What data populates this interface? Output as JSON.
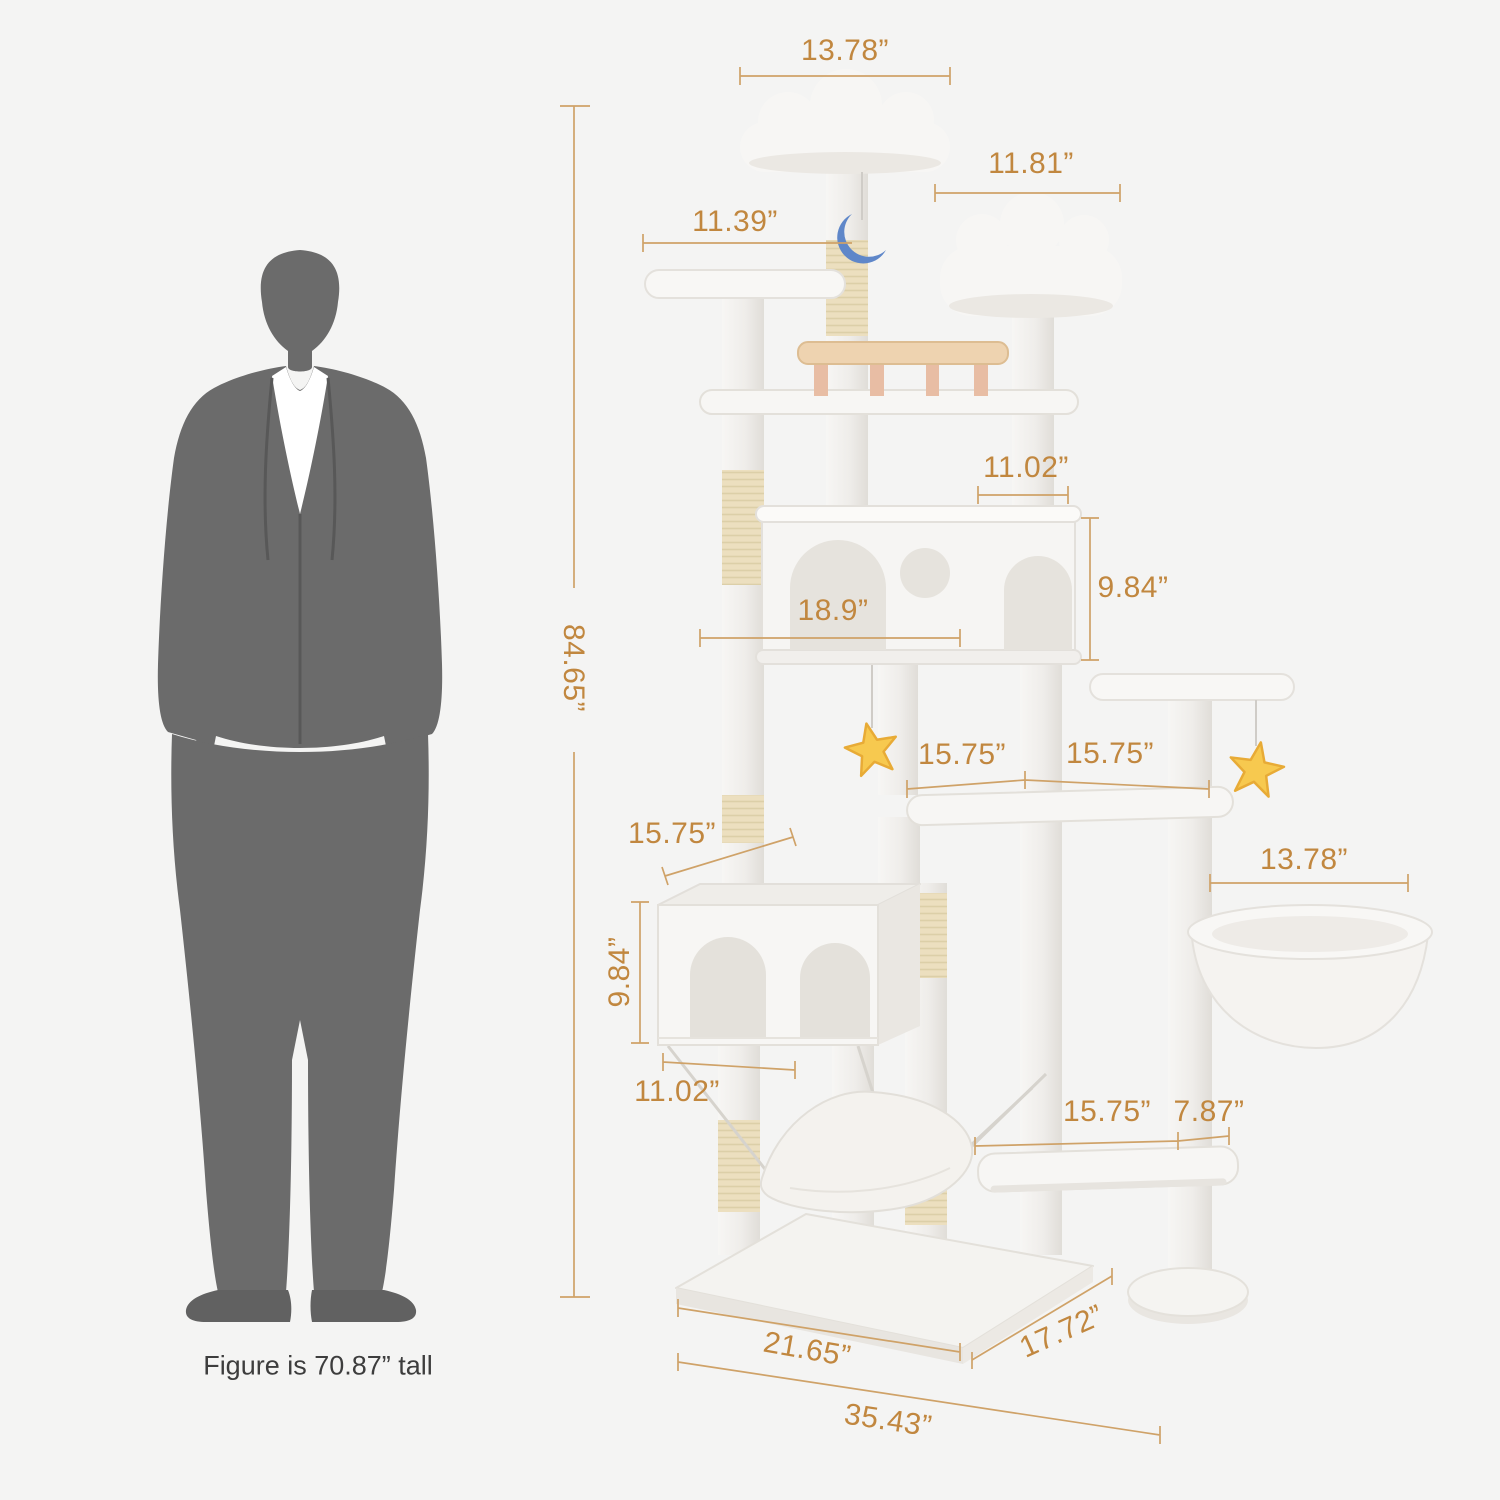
{
  "figure": {
    "caption": "Figure is 70.87”  tall"
  },
  "dims": {
    "top_cloud_width": "13.78”",
    "second_cloud_width": "11.81”",
    "left_perch_width": "11.39”",
    "upper_condo_depth": "11.02”",
    "upper_condo_height": "9.84”",
    "upper_condo_width": "18.9”",
    "total_height": "84.65”",
    "mid_platform_left": "15.75”",
    "mid_platform_right": "15.75”",
    "basket_width": "13.78”",
    "lower_condo_width": "15.75”",
    "lower_condo_height": "9.84”",
    "lower_condo_depth": "11.02”",
    "bottom_platform_length": "15.75”",
    "bottom_platform_gap": "7.87”",
    "base_width": "21.65”",
    "base_depth": "17.72”",
    "total_width": "35.43”"
  },
  "colors": {
    "background": "#f4f4f3",
    "dimension_text": "#c1873f",
    "dimension_line": "#cfa268",
    "silhouette": "#6b6b6b",
    "plush": "#f7f6f4",
    "sisal": "#ecdfbf",
    "star_toy": "#f7c94f",
    "moon_toy": "#5f87c9",
    "wood_table": "#eed3b0"
  }
}
